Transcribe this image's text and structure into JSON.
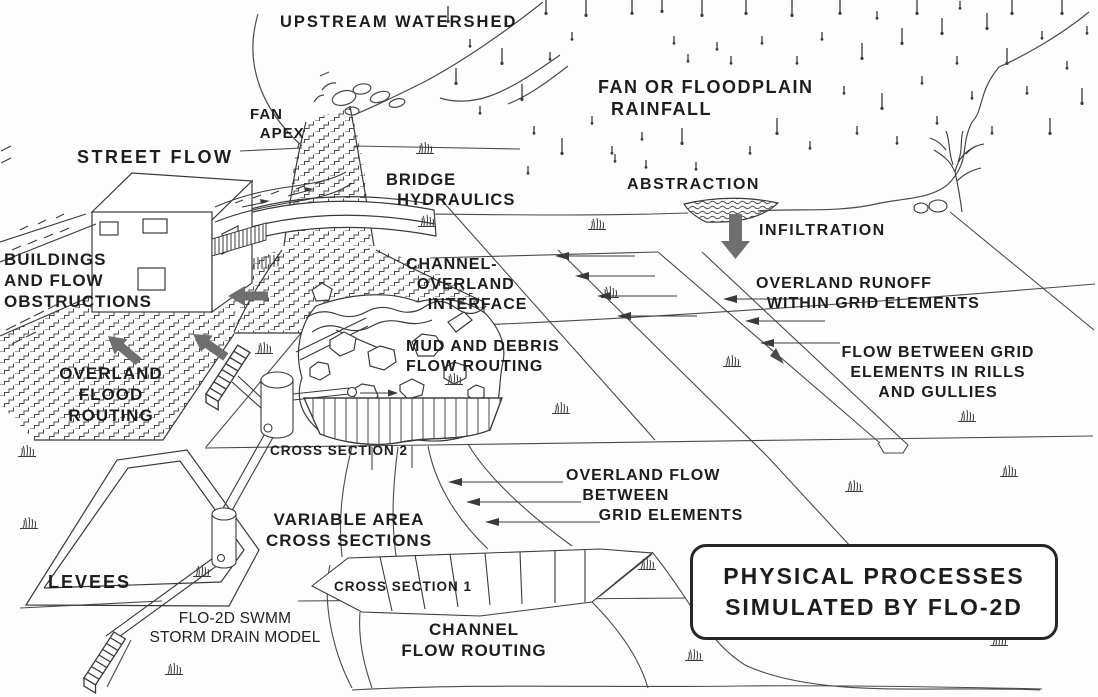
{
  "diagram": {
    "title_box": {
      "line1": "PHYSICAL PROCESSES",
      "line2": "SIMULATED BY FLO-2D"
    },
    "labels": {
      "upstream_watershed": "UPSTREAM WATERSHED",
      "fan_apex": "FAN\n  APEX",
      "street_flow": "STREET FLOW",
      "rainfall": "FAN OR FLOODPLAIN\n  RAINFALL",
      "abstraction": "ABSTRACTION",
      "infiltration": "INFILTRATION",
      "bridge_hydraulics": "BRIDGE\n  HYDRAULICS",
      "buildings": "BUILDINGS\nAND FLOW\nOBSTRUCTIONS",
      "channel_overland": "CHANNEL-\n  OVERLAND\n    INTERFACE",
      "overland_runoff": "OVERLAND RUNOFF\n  WITHIN GRID ELEMENTS",
      "mud_debris": "MUD AND DEBRIS\nFLOW ROUTING",
      "flow_rills": "FLOW BETWEEN GRID\nELEMENTS IN RILLS\nAND GULLIES",
      "overland_flood": "OVERLAND\nFLOOD\nROUTING",
      "cross_section_2": "CROSS SECTION 2",
      "overland_flow_between": "OVERLAND FLOW\n   BETWEEN\n      GRID ELEMENTS",
      "variable_area": "VARIABLE AREA\nCROSS SECTIONS",
      "levees": "LEVEES",
      "swmm": "FLO-2D SWMM\nSTORM DRAIN MODEL",
      "cross_section_1": "CROSS SECTION 1",
      "channel_flow": "CHANNEL\nFLOW ROUTING"
    },
    "colors": {
      "ink": "#3a3a3a",
      "text": "#1d1d1d",
      "gray_arrow": "#6f6f6f",
      "background": "#fdfdfd"
    }
  }
}
